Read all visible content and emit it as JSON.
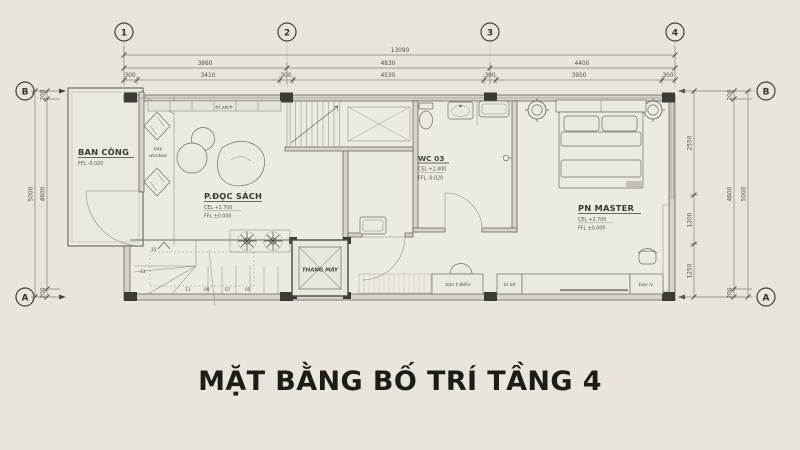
{
  "title": "MẶT BẰNG BỐ TRÍ TẦNG 4",
  "colors": {
    "background": "#e9e5dd",
    "wall": "#57564f",
    "column": "#3b3a36",
    "ink": "#3a3934",
    "title": "#1d1c18"
  },
  "grid": {
    "c1": "1",
    "c2": "2",
    "c3": "3",
    "c4": "4",
    "row_b": "B",
    "row_a": "A"
  },
  "dims": {
    "h_total": "13090",
    "h2": [
      "3860",
      "4830",
      "4400"
    ],
    "h3": [
      "300",
      "3410",
      "300",
      "4530",
      "300",
      "3950",
      "300"
    ],
    "v_left_total": "5000",
    "v_left": [
      "200",
      "4600",
      "200"
    ],
    "v_right_inner": [
      "2550",
      "1200",
      "1250"
    ],
    "v_right": [
      "200",
      "4600",
      "200"
    ],
    "v_right_total": "5000"
  },
  "rooms": {
    "balcony": {
      "name": "BAN CÔNG",
      "ffl": "FFL -0.020"
    },
    "reading": {
      "name": "P.ĐỌC SÁCH",
      "cel": "CEL +2.700",
      "ffl": "FFL ±0.000"
    },
    "wc": {
      "name": "WC 03",
      "cel": "CEL +2.400",
      "ffl": "FFL -0.020"
    },
    "master": {
      "name": "PN MASTER",
      "cel": "CEL +2.700",
      "ffl": "FFL ±0.000"
    },
    "elevator": {
      "name": "THANG MÁY"
    }
  },
  "furniture": {
    "bookshelf": "tủ sách",
    "bay_line1": "bay",
    "bay_line2": "window",
    "dressing_table": "bàn t.điểm",
    "cabinet": "tủ kệ",
    "desk": "bàn lv"
  },
  "stair_numbers": [
    "15",
    "13",
    "11",
    "09",
    "07",
    "05"
  ]
}
